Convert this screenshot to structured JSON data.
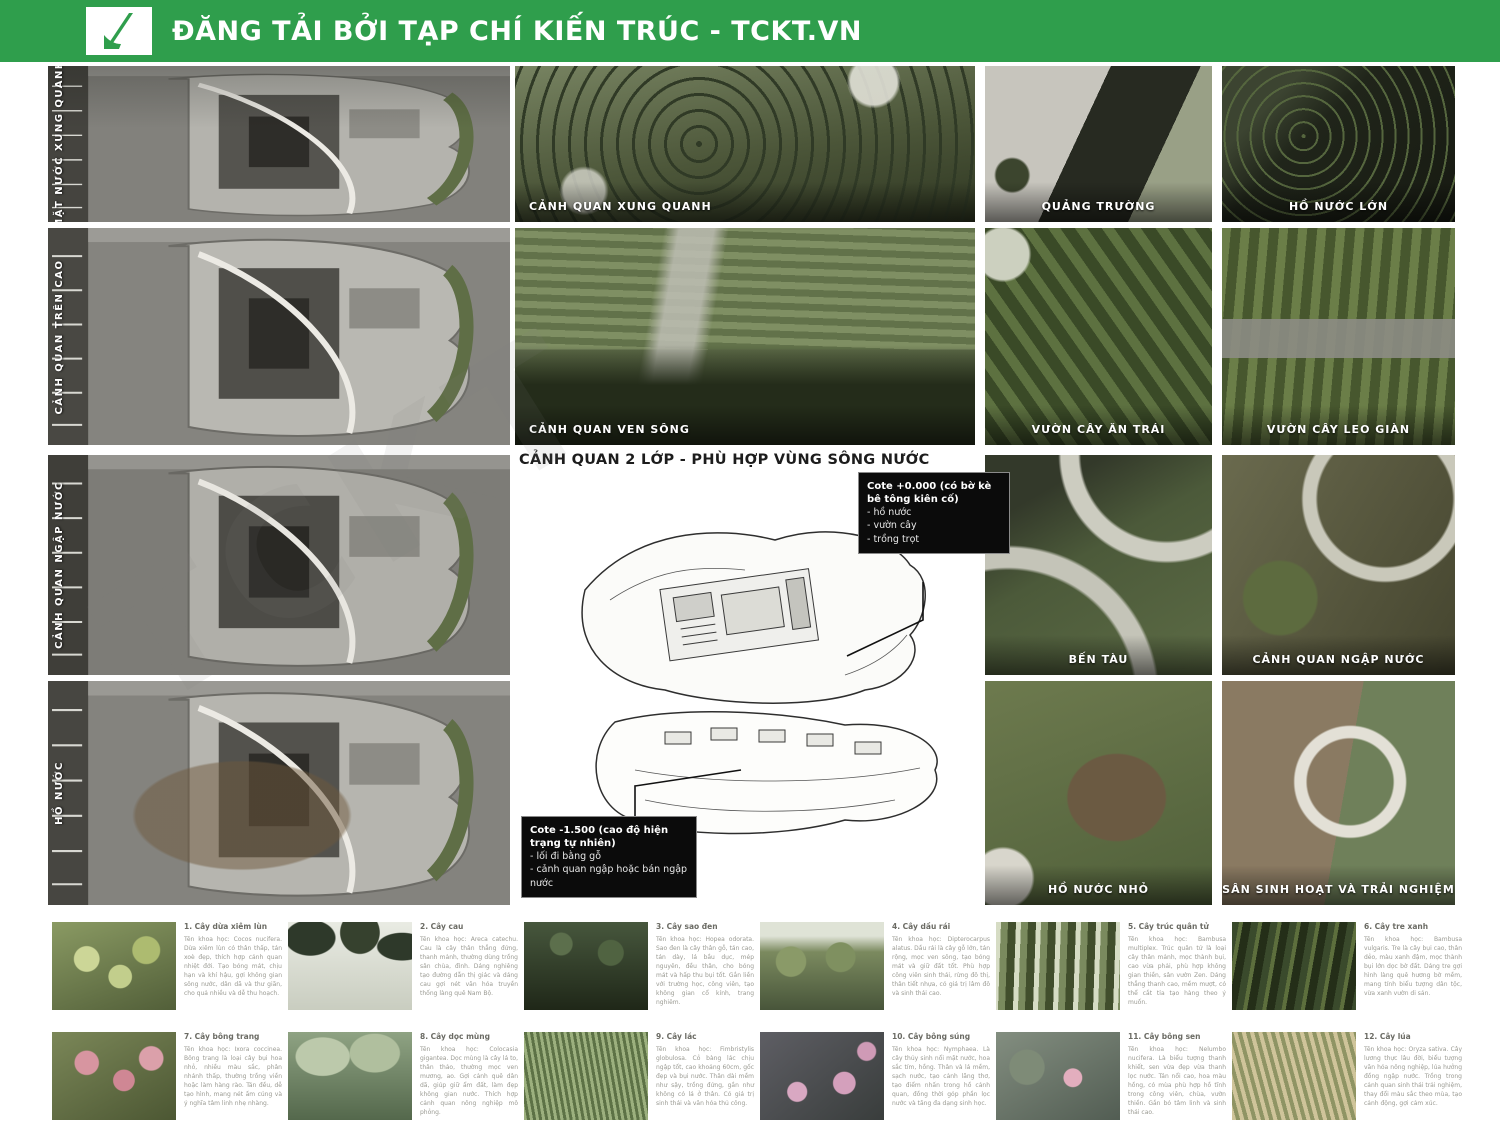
{
  "header": {
    "title": "ĐĂNG TẢI BỞI TẠP CHÍ KIẾN TRÚC - TCKT.VN",
    "brand_color": "#2f9e4c",
    "logo": "tckt-logo"
  },
  "watermark": "TCKT",
  "left_plans": [
    {
      "label": "MẶT NƯỚC XUNG QUANH"
    },
    {
      "label": "CẢNH QUAN TRÊN CAO"
    },
    {
      "label": "CẢNH QUAN NGẬP NƯỚC"
    },
    {
      "label": "HỒ NƯỚC"
    }
  ],
  "center": {
    "top_panels": [
      {
        "label": "CẢNH QUAN XUNG QUANH"
      },
      {
        "label": "CẢNH QUAN VEN SÔNG"
      }
    ],
    "diagram": {
      "title": "CẢNH QUAN 2 LỚP - PHÙ HỢP VÙNG SÔNG NƯỚC",
      "callout_top": {
        "heading": "Cote +0.000 (có bờ kè bê tông kiên cố)",
        "items": [
          "- hồ nước",
          "- vườn cây",
          "- trồng trọt"
        ]
      },
      "callout_bottom": {
        "heading": "Cote -1.500 (cao độ hiện trạng tự nhiên)",
        "items": [
          "- lối đi bằng gỗ",
          "- cảnh quan ngập hoặc bán ngập nước"
        ]
      }
    }
  },
  "right_panels": [
    {
      "label": "QUẢNG TRƯỜNG"
    },
    {
      "label": "HỒ NƯỚC LỚN"
    },
    {
      "label": "VƯỜN CÂY ĂN TRÁI"
    },
    {
      "label": "VƯỜN CÂY LEO GIÀN"
    },
    {
      "label": "BẾN TÀU"
    },
    {
      "label": "CẢNH QUAN NGẬP NƯỚC"
    },
    {
      "label": "HỒ NƯỚC NHỎ"
    },
    {
      "label": "SÂN SINH HOẠT VÀ TRẢI NGHIỆM"
    }
  ],
  "plants": [
    {
      "title": "1. Cây dừa xiêm lùn",
      "photo": "coconut-palm-photo",
      "desc": "Tên khoa học: Cocos nucifera. Dừa xiêm lùn có thân thấp, tán xoè đẹp, thích hợp cảnh quan nhiệt đới. Tạo bóng mát, chịu hạn và khí hậu, gợi không gian sông nước, dân dã và thư giãn, cho quả nhiều và dễ thu hoạch."
    },
    {
      "title": "2. Cây cau",
      "photo": "areca-palm-photo",
      "desc": "Tên khoa học: Areca catechu. Cau là cây thân thẳng đứng, thanh mảnh, thường dùng trồng sân chùa, đình. Dáng nghiêng tạo đường dẫn thị giác và dáng cau gợi nét văn hóa truyền thống làng quê Nam Bộ."
    },
    {
      "title": "3. Cây sao đen",
      "photo": "hopea-forest-photo",
      "desc": "Tên khoa học: Hopea odorata. Sao đen là cây thân gỗ, tán cao, tán dày, lá bầu dục, mép nguyên, đều thân, cho bóng mát và hấp thu bụi tốt. Gắn liền với trường học, công viên, tạo không gian cổ kính, trang nghiêm."
    },
    {
      "title": "4. Cây dầu rái",
      "photo": "dipterocarpus-photo",
      "desc": "Tên khoa học: Dipterocarpus alatus. Dầu rái là cây gỗ lớn, tán rộng, mọc ven sông, tạo bóng mát và giữ đất tốt. Phù hợp công viên sinh thái, rừng đô thị, thân tiết nhựa, có giá trị lâm đô và sinh thái cao."
    },
    {
      "title": "5. Cây trúc quân tử",
      "photo": "bambusa-multiplex-photo",
      "desc": "Tên khoa học: Bambusa multiplex. Trúc quân tử là loại cây thân mảnh, mọc thành bụi, cao vừa phải, phù hợp không gian thiền, sân vườn Zen. Dáng thẳng thanh cao, mềm mượt, có thể cắt tỉa tạo hàng theo ý muốn."
    },
    {
      "title": "6. Cây tre xanh",
      "photo": "green-bamboo-photo",
      "desc": "Tên khoa học: Bambusa vulgaris. Tre là cây bụi cao, thân dẻo, màu xanh đậm, mọc thành bụi lớn dọc bờ đất. Dáng tre gợi hình làng quê hương bờ mềm, mang tính biểu tượng dân tộc, vừa xanh vườn di sản."
    },
    {
      "title": "7. Cây bông trang",
      "photo": "ixora-photo",
      "desc": "Tên khoa học: Ixora coccinea. Bông trang là loại cây bụi hoa nhỏ, nhiều màu sắc, phân nhánh thấp, thường trồng viền hoặc làm hàng rào. Tán đều, dễ tạo hình, mang nét ấm cúng và ý nghĩa tâm linh nhẹ nhàng."
    },
    {
      "title": "8. Cây dọc mùng",
      "photo": "taro-leaf-photo",
      "desc": "Tên khoa học: Colocasia gigantea. Dọc mùng là cây lá to, thân thảo, thường mọc ven mương, ao. Gợi cảnh quê dân dã, giúp giữ ẩm đất, làm đẹp không gian nước. Thích hợp cảnh quan nông nghiệp mô phỏng."
    },
    {
      "title": "9. Cây lác",
      "photo": "sedge-grass-photo",
      "desc": "Tên khoa học: Fimbristylis globulosa. Cỏ bàng lác chịu ngập tốt, cao khoảng 60cm, gốc đẹp và bụi nước. Thân dài mềm như sậy, trồng đứng, gần như không có lá ở thân. Có giá trị sinh thái và văn hóa thủ công."
    },
    {
      "title": "10. Cây bông súng",
      "photo": "waterlily-photo",
      "desc": "Tên khoa học: Nymphaea. Là cây thủy sinh nổi mặt nước, hoa sắc tím, hồng. Thân và lá mềm, sạch nước, tạo cảnh lãng thơ, tạo điểm nhấn trong hồ cảnh quan, đồng thời góp phần lọc nước và tăng đa dạng sinh học."
    },
    {
      "title": "11. Cây bông sen",
      "photo": "lotus-photo",
      "desc": "Tên khoa học: Nelumbo nucifera. Là biểu tượng thanh khiết, sen vừa đẹp vừa thanh lọc nước. Tán nổi cao, hoa màu hồng, có mùa phù hợp hồ tĩnh trong công viên, chùa, vườn thiền. Gắn bó tâm linh và sinh thái cao."
    },
    {
      "title": "12. Cây lúa",
      "photo": "rice-plant-photo",
      "desc": "Tên khoa học: Oryza sativa. Cây lương thực lâu đời, biểu tượng văn hóa nông nghiệp, lúa hưởng đồng ngập nước. Trồng trong cảnh quan sinh thái trải nghiệm, thay đổi màu sắc theo mùa, tạo cảnh động, gợi cảm xúc."
    }
  ]
}
